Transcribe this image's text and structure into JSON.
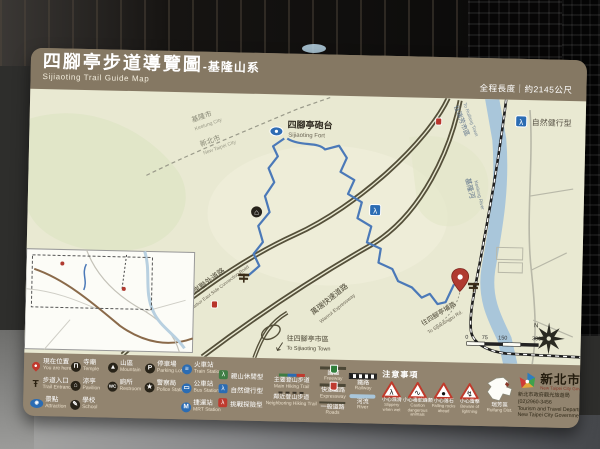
{
  "header": {
    "title_zh": "四腳亭步道導覽圖",
    "title_suffix": "-基隆山系",
    "title_en": "Sijiaoting Trail Guide Map",
    "length_label": "全程長度｜約2145公尺"
  },
  "map": {
    "keelung_city_zh": "基隆市",
    "keelung_city_en": "Keelung City",
    "new_taipei_zh": "新北市",
    "new_taipei_en": "New Taipei City",
    "fort_zh": "四腳亭砲台",
    "fort_en": "Sijiaoting Fort",
    "type_badge_zh": "自然健行型",
    "hiker_glyph": "λ",
    "pavilion_glyph": "⌂",
    "river_zh": "基隆河",
    "river_en": "Keelung River",
    "to_ruifang_zh": "往瑞芳市區",
    "to_ruifang_en": "To Ruifang Town",
    "to_town_zh": "往四腳亭市區",
    "to_town_en": "To Sijiaoting Town",
    "to_pu_road_zh": "往四腳亭埔路",
    "to_pu_road_en": "To Sijiaotingpu Rd.",
    "road_harbor_zh": "基隆港東岸聯外道路",
    "road_harbor_en": "Keelung Harbor East Side Connection Road",
    "road_wanrui_zh": "萬瑞快速道路",
    "road_wanrui_en": "Wanrui Expressway",
    "scale_0": "0",
    "scale_75": "75",
    "scale_150": "150",
    "scale_300": "300(M)",
    "compass_n": "N"
  },
  "legend": {
    "symbols": [
      {
        "zh": "現在位置",
        "en": "You are here"
      },
      {
        "zh": "寺廟",
        "en": "Temple",
        "glyph": "Π"
      },
      {
        "zh": "山區",
        "en": "Mountain",
        "glyph": "▲"
      },
      {
        "zh": "停車場",
        "en": "Parking Lot",
        "glyph": "P"
      },
      {
        "zh": "火車站",
        "en": "Train Station",
        "glyph": "≡"
      },
      {
        "zh": "步道入口",
        "en": "Trail Entrance",
        "glyph": "Ŧ"
      },
      {
        "zh": "涼亭",
        "en": "Pavilion",
        "glyph": "⌂"
      },
      {
        "zh": "廁所",
        "en": "Restroom",
        "glyph": "WC"
      },
      {
        "zh": "警察局",
        "en": "Police Station",
        "glyph": "★"
      },
      {
        "zh": "公車站",
        "en": "Bus Station",
        "glyph": "▭"
      },
      {
        "zh": "景點",
        "en": "Attraction",
        "glyph": "◉"
      },
      {
        "zh": "學校",
        "en": "School",
        "glyph": "✎"
      },
      {
        "zh": "捷運站",
        "en": "MRT Station",
        "glyph": "M"
      }
    ],
    "trail_types": [
      {
        "zh": "親山休閒型",
        "color": "#3f7d44"
      },
      {
        "zh": "自然健行型",
        "color": "#2b6cb3"
      },
      {
        "zh": "挑戰探險型",
        "color": "#bf3a2e"
      }
    ],
    "lines": [
      {
        "zh": "主要登山步道",
        "en": "Main Hiking Trail"
      },
      {
        "zh": "鄰近登山步道",
        "en": "Neighboring Hiking Trail"
      },
      {
        "zh": "國道",
        "en": "Freeway"
      },
      {
        "zh": "快速道路",
        "en": "Expressway"
      },
      {
        "zh": "一般道路",
        "en": "Roads"
      },
      {
        "zh": "鐵路",
        "en": "Railway"
      },
      {
        "zh": "河流",
        "en": "River"
      }
    ],
    "notice_title": "注意事項",
    "cautions": [
      {
        "zh": "小心濕滑",
        "en": "Slippery when wet",
        "glyph": "λ"
      },
      {
        "zh": "小心毒蛇蜂類",
        "en": "Caution dangerous animals",
        "glyph": "∿"
      },
      {
        "zh": "小心落石",
        "en": "Falling rocks ahead",
        "glyph": "●"
      },
      {
        "zh": "小心雷擊",
        "en": "Beware of lightning",
        "glyph": "↯"
      }
    ],
    "district_zh": "瑞芳區",
    "district_en": "Ruifang Dist.",
    "gov_name_zh": "新北市政府",
    "gov_name_en": "New Taipei City Government",
    "gov_dept_zh": "新北市政府觀光旅遊局",
    "gov_phone": "(02)2960-3456",
    "gov_dept_en1": "Tourism and Travel Department,",
    "gov_dept_en2": "New Taipei City Government"
  }
}
